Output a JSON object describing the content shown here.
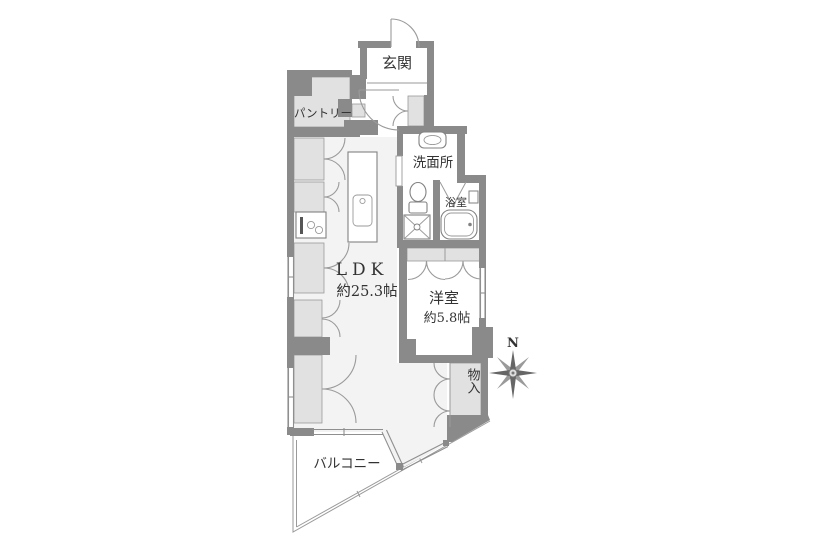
{
  "colors": {
    "wall": "#8a8a8a",
    "room-light": "#e1e1e1",
    "floor": "#f3f3f3",
    "line": "#9a9a9a",
    "text": "#333333",
    "bg": "#ffffff"
  },
  "rooms": {
    "genkan": {
      "label": "玄関"
    },
    "pantry": {
      "label": "パントリー"
    },
    "washroom": {
      "label": "洗面所"
    },
    "bathroom": {
      "label": "浴室"
    },
    "ldk": {
      "label": "LDK",
      "size": "約25.3帖"
    },
    "western_room": {
      "label": "洋室",
      "size": "約5.8帖"
    },
    "storage": {
      "label": "物入"
    },
    "balcony": {
      "label": "バルコニー"
    }
  },
  "compass": {
    "north_label": "N"
  }
}
